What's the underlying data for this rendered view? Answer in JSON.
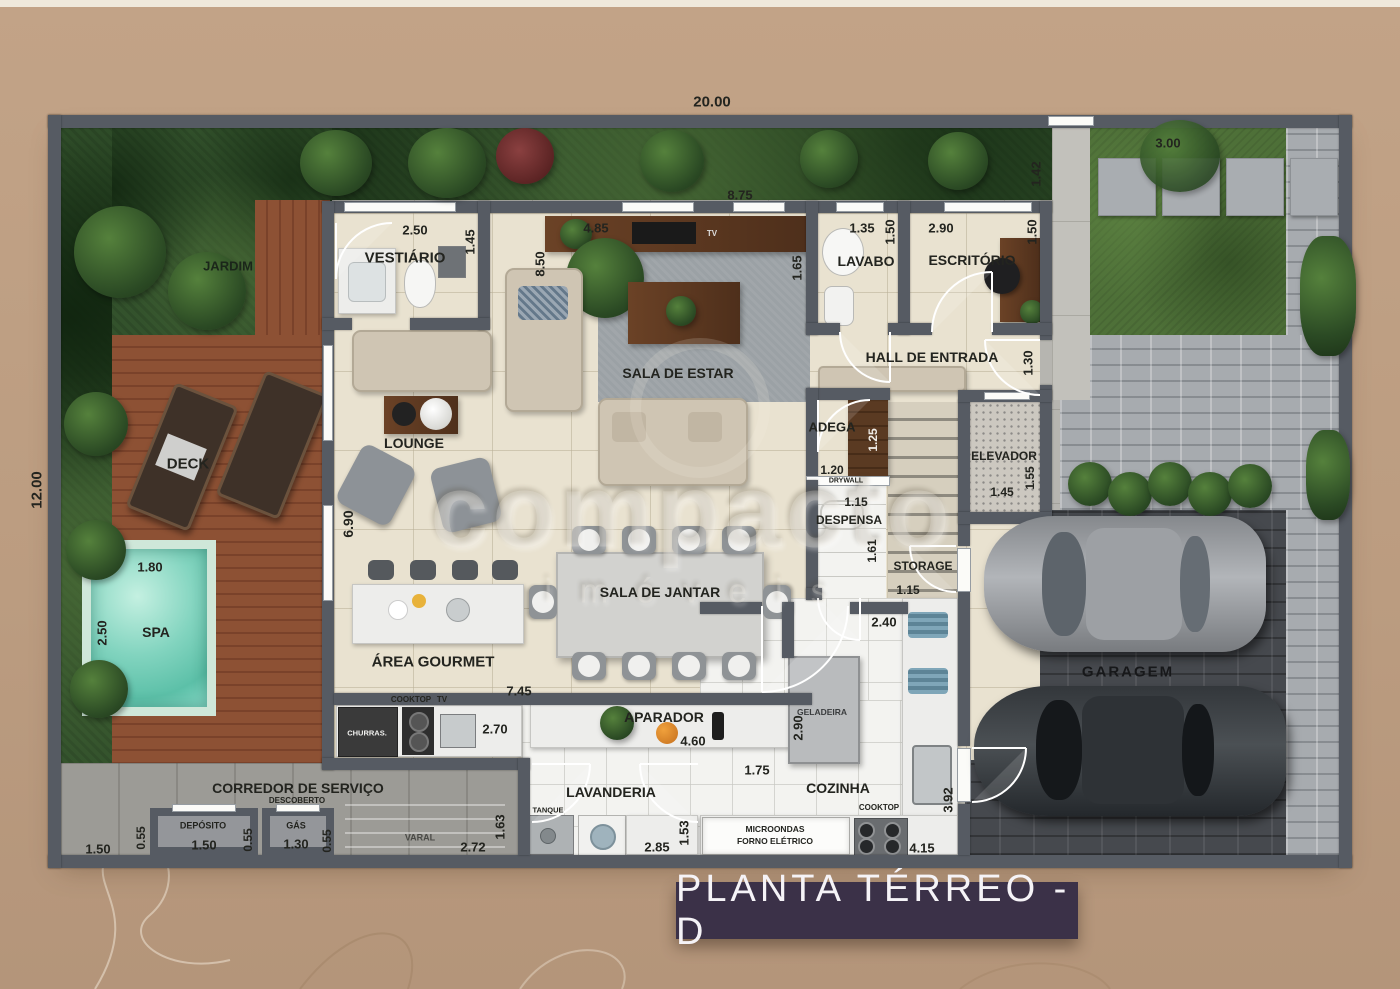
{
  "banner": {
    "title": "PLANTA TÉRREO - D"
  },
  "watermark": {
    "brand": "compacto",
    "tagline": "imóveis"
  },
  "site": {
    "total_width": "20.00",
    "total_height": "12.00",
    "gate_width": "1.42",
    "stones_width": "3.00"
  },
  "rooms": {
    "jardim": {
      "label": "JARDIM"
    },
    "vestiario": {
      "label": "VESTIÁRIO",
      "width": "2.50",
      "depth": "1.45"
    },
    "sala_estar": {
      "label": "SALA DE ESTAR",
      "depth": "8.50",
      "width": "4.85",
      "wall_width": "8.75",
      "tv": "TV"
    },
    "lavabo": {
      "label": "LAVABO",
      "width": "1.35",
      "depth": "1.50",
      "side": "1.65"
    },
    "escritorio": {
      "label": "ESCRITÓRIO",
      "width": "2.90",
      "depth": "1.50"
    },
    "hall": {
      "label": "HALL DE ENTRADA",
      "door": "1.30"
    },
    "lounge": {
      "label": "LOUNGE"
    },
    "deck": {
      "label": "DECK"
    },
    "spa": {
      "label": "SPA",
      "width": "1.80",
      "depth": "2.50"
    },
    "living_width": "6.90",
    "adega": {
      "label": "ADEGA",
      "depth": "1.25",
      "width": "1.20"
    },
    "elevador": {
      "label": "ELEVADOR",
      "width": "1.45",
      "depth": "1.55"
    },
    "despensa": {
      "label": "DESPENSA",
      "drywall": "DRYWALL",
      "width": "1.15",
      "depth": "1.61"
    },
    "storage": {
      "label": "STORAGE",
      "width": "1.15"
    },
    "jantar": {
      "label": "SALA DE JANTAR"
    },
    "gourmet": {
      "label": "ÁREA GOURMET",
      "width": "7.45",
      "counter": "2.70",
      "cooktop": "COOKTOP",
      "tv": "TV",
      "churrasqueira": "CHURRAS."
    },
    "aparador": {
      "label": "APARADOR",
      "width": "4.60",
      "depth": "2.90"
    },
    "cozinha": {
      "label": "COZINHA",
      "door": "2.40",
      "width": "1.75",
      "depth": "3.92",
      "counter": "4.15",
      "geladeira": "GELADEIRA",
      "cooktop": "COOKTOP",
      "micro1": "MICROONDAS",
      "micro2": "FORNO ELÉTRICO"
    },
    "lavanderia": {
      "label": "LAVANDERIA",
      "width": "2.85",
      "depth": "1.53",
      "side": "1.63",
      "tanque": "TANQUE"
    },
    "corredor": {
      "label": "CORREDOR DE SERVIÇO",
      "sub": "DESCOBERTO",
      "left": "1.50",
      "gap1": "0.55",
      "deposito": "DEPÓSITO",
      "deposito_w": "1.50",
      "gap2": "0.55",
      "gas": "GÁS",
      "gas_w": "1.30",
      "gap3": "0.55",
      "varal": "VARAL",
      "varal_w": "2.72"
    },
    "garagem": {
      "label": "GARAGEM"
    }
  }
}
